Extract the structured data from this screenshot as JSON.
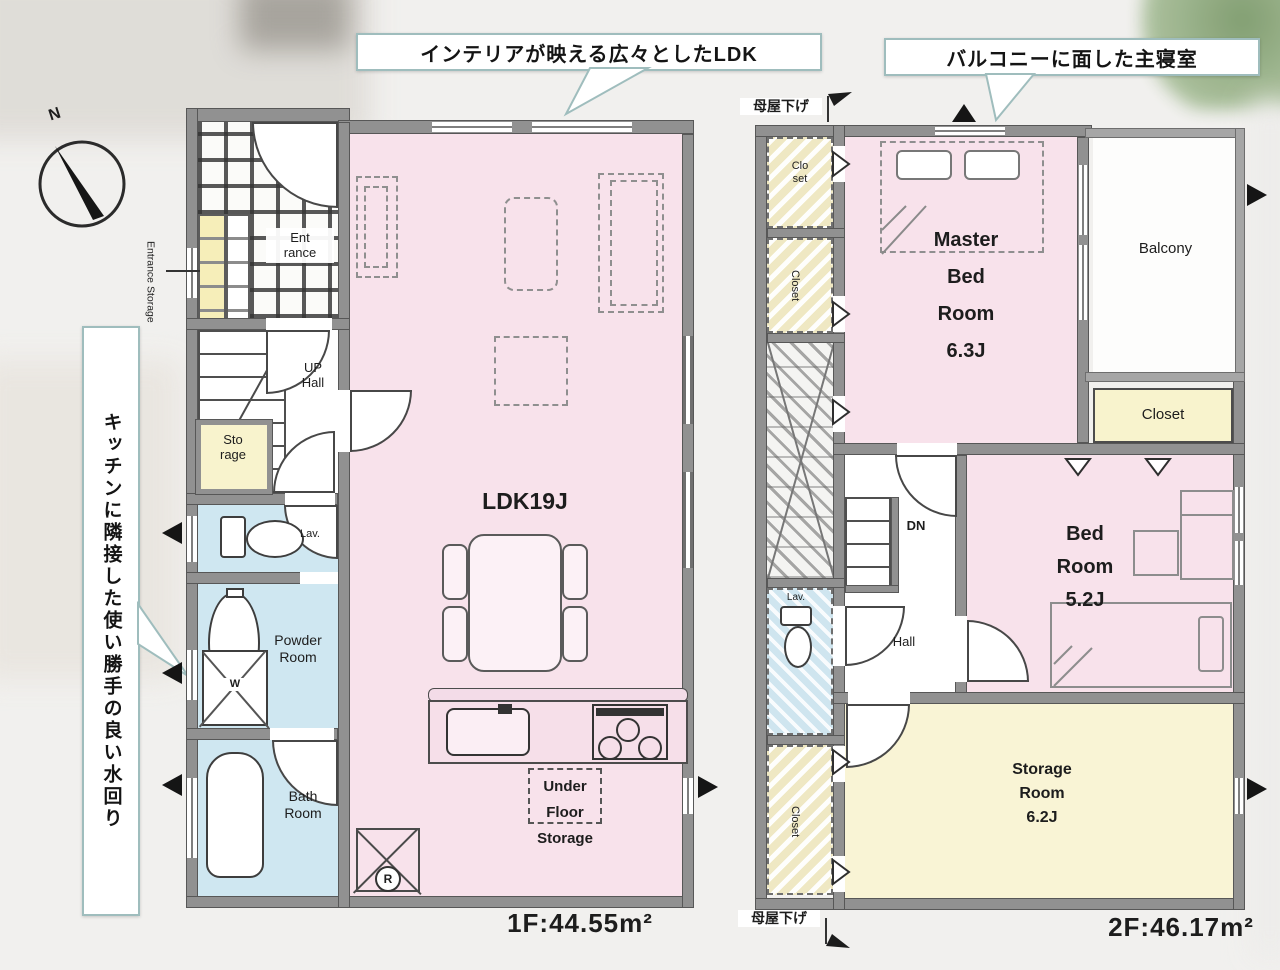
{
  "callouts": {
    "ldk": "インテリアが映える広々としたLDK",
    "master": "バルコニーに面した主寝室",
    "water": "キッチンに隣接した使い勝手の良い水回り"
  },
  "compass": {
    "north": "N"
  },
  "f1": {
    "entrance_storage": "Entrance Storage",
    "entrance": "Ent\nrance",
    "up_hall": "UP\nHall",
    "storage": "Sto\nrage",
    "lav": "Lav.",
    "powder_room": "Powder\nRoom",
    "bath_room": "Bath\nRoom",
    "ldk": "LDK19J",
    "under_floor_storage": "Under\nFloor\nStorage",
    "refrigerator": "R",
    "washer": "W",
    "area": "1F:44.55m²"
  },
  "f2": {
    "moyasage_top": "母屋下げ",
    "moyasage_bottom": "母屋下げ",
    "closet_top": "Clo\nset",
    "closet_upper": "Closet",
    "closet_lower": "Closet",
    "closet_right": "Closet",
    "lav": "Lav.",
    "dn": "DN",
    "hall": "Hall",
    "master_bedroom": "Master\nBed\nRoom\n6.3J",
    "balcony": "Balcony",
    "bedroom": "Bed\nRoom\n5.2J",
    "storage_room": "Storage\nRoom\n6.2J",
    "area": "2F:46.17m²"
  },
  "colors": {
    "room_pink": "#f8e2eb",
    "room_blue": "#cfe7f1",
    "room_yellow": "#f8f3cd",
    "wall_gray": "#919191",
    "callout_border": "#9fbdbd"
  }
}
